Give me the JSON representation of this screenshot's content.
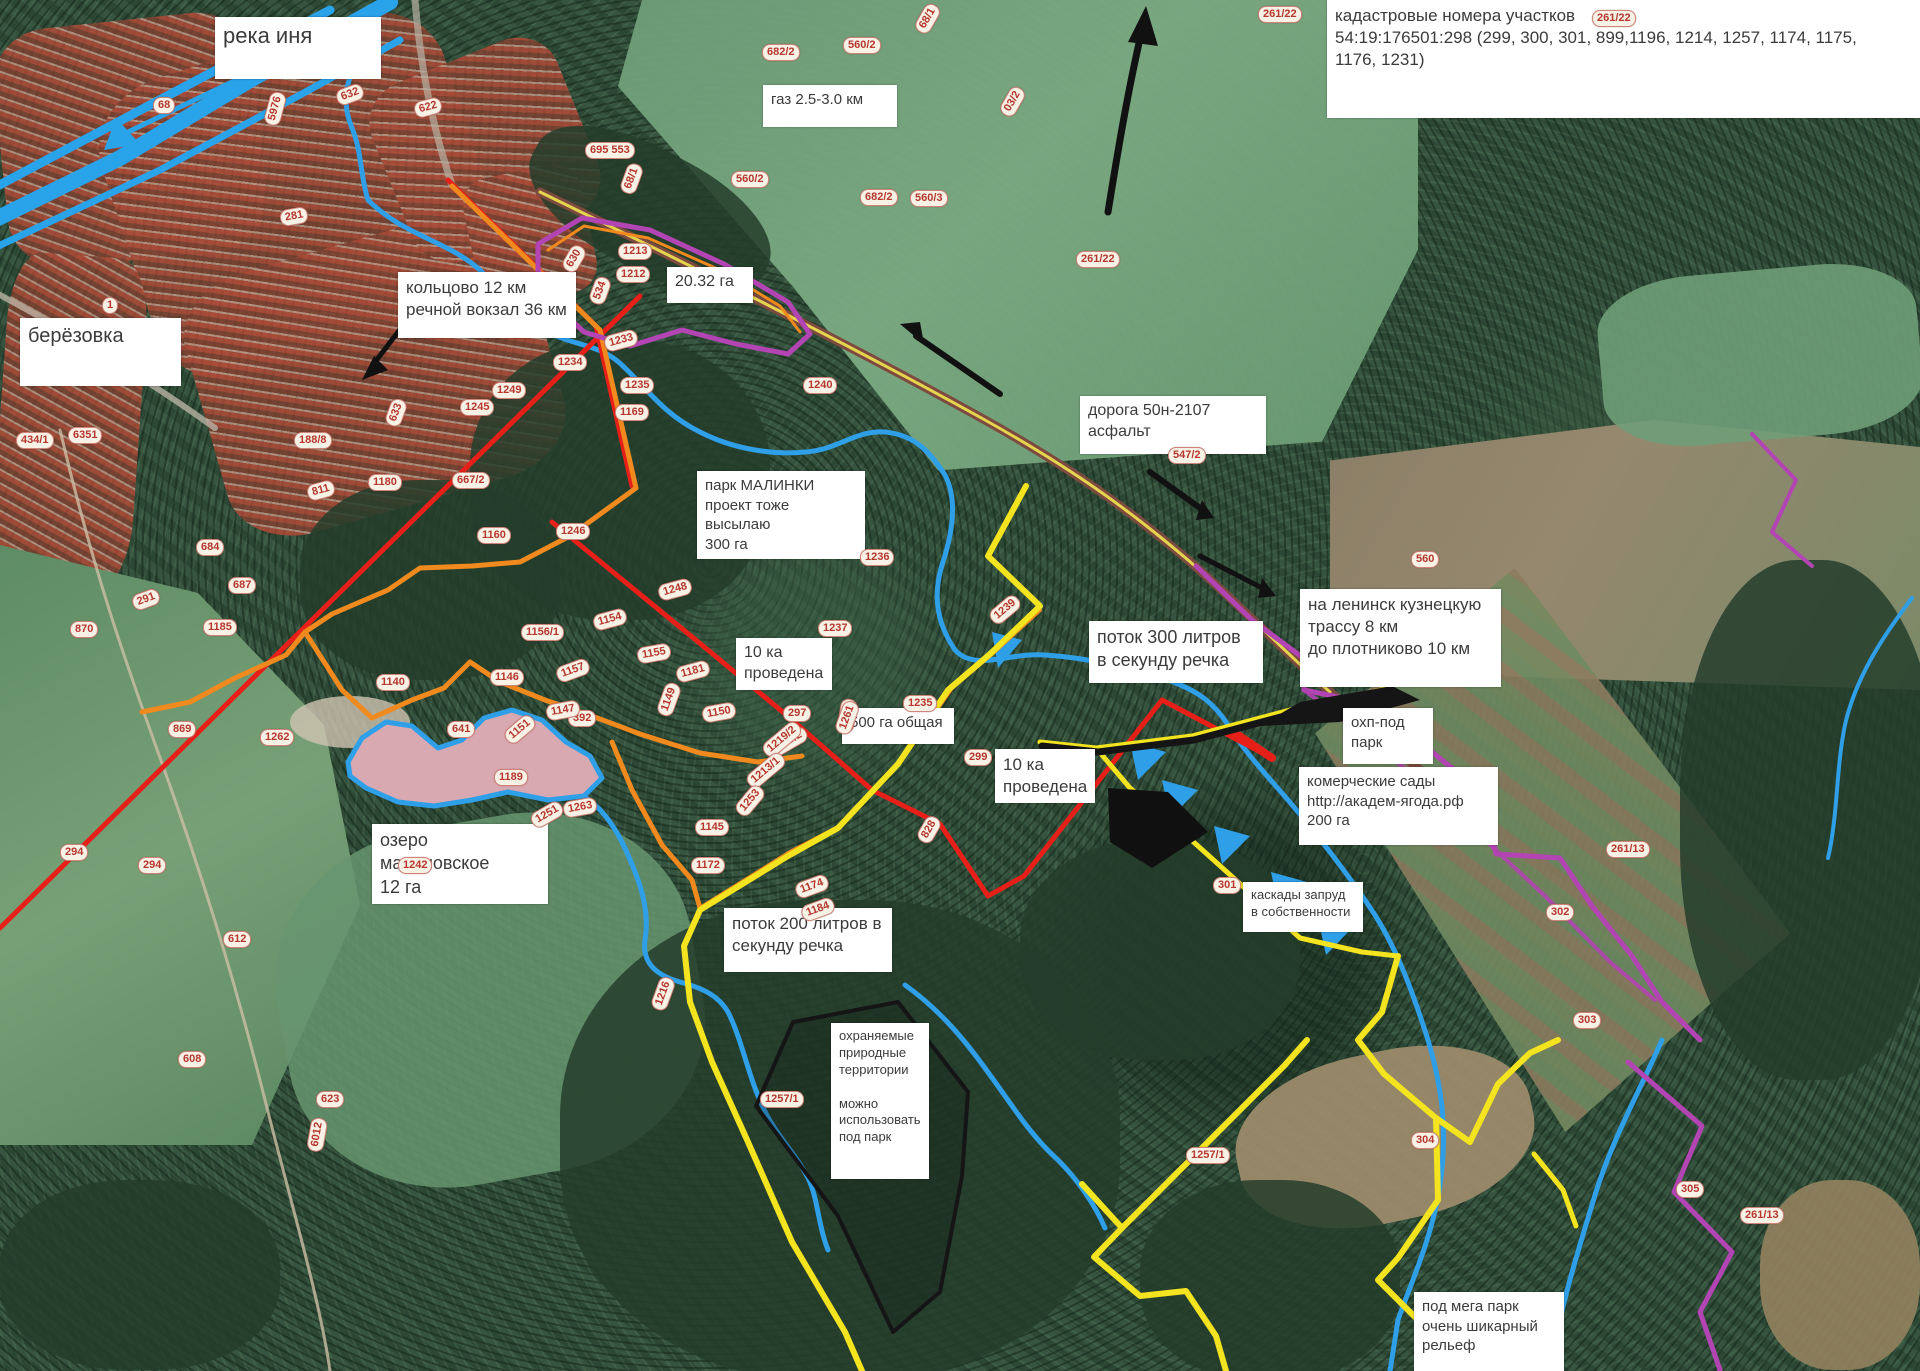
{
  "title": "карта участков (спутник) — малинки",
  "colors": {
    "river": "#2f9fe8",
    "boundary_red": "#e62019",
    "boundary_orange": "#f08a1e",
    "boundary_yellow": "#f4e420",
    "boundary_purple": "#b344b3",
    "road_brown": "#7c4a3e",
    "arrow_black": "#111111",
    "lake_fill": "#d9a9b2",
    "annotation_bg": "#ffffff",
    "annotation_text": "#3b3b3b",
    "cadastral_text": "#b5372e"
  },
  "annotations": [
    {
      "id": "reka-inya",
      "x": 215,
      "y": 17,
      "w": 150,
      "h": 52,
      "fs": 22,
      "lines": [
        "река иня"
      ]
    },
    {
      "id": "kadastr-numbers",
      "x": 1327,
      "y": 0,
      "w": 590,
      "h": 108,
      "fs": 17,
      "lines": [
        "кадастровые номера участков",
        "54:19:176501:298 (299, 300, 301, 899,1196, 1214, 1257, 1174, 1175,",
        "1176, 1231)"
      ]
    },
    {
      "id": "gaz",
      "x": 763,
      "y": 85,
      "w": 118,
      "h": 32,
      "fs": 15,
      "lines": [
        "газ 2.5-3.0 км"
      ]
    },
    {
      "id": "berezovka",
      "x": 20,
      "y": 318,
      "w": 145,
      "h": 58,
      "fs": 20,
      "lines": [
        "берёзовка"
      ]
    },
    {
      "id": "koltsovo",
      "x": 398,
      "y": 272,
      "w": 162,
      "h": 56,
      "fs": 17,
      "lines": [
        "кольцово 12 км",
        "речной вокзал 36 км"
      ]
    },
    {
      "id": "ga-20-32",
      "x": 667,
      "y": 267,
      "w": 70,
      "h": 26,
      "fs": 16,
      "lines": [
        "20.32 га"
      ]
    },
    {
      "id": "doroga-50n-2107",
      "x": 1080,
      "y": 396,
      "w": 170,
      "h": 48,
      "fs": 16,
      "lines": [
        "дорога 50н-2107",
        "асфальт"
      ]
    },
    {
      "id": "park-malinki",
      "x": 697,
      "y": 471,
      "w": 152,
      "h": 60,
      "fs": 15,
      "lines": [
        "парк  МАЛИНКИ",
        "проект тоже высылаю",
        "300 га"
      ]
    },
    {
      "id": "lep-10-1",
      "x": 736,
      "y": 638,
      "w": 80,
      "h": 38,
      "fs": 16,
      "lines": [
        "10 ка",
        "проведена"
      ]
    },
    {
      "id": "potok-300",
      "x": 1089,
      "y": 621,
      "w": 158,
      "h": 52,
      "fs": 18,
      "lines": [
        "поток 300 литров",
        "в секунду речка"
      ]
    },
    {
      "id": "leninsk-trassa",
      "x": 1300,
      "y": 589,
      "w": 185,
      "h": 88,
      "fs": 17,
      "lines": [
        "на ленинск кузнецкую",
        "трассу 8 км",
        "до плотниково 10 км"
      ]
    },
    {
      "id": "ohp-pod-park",
      "x": 1343,
      "y": 708,
      "w": 74,
      "h": 46,
      "fs": 15,
      "lines": [
        "охп-под",
        "парк"
      ]
    },
    {
      "id": "kommercheskie-sady",
      "x": 1299,
      "y": 767,
      "w": 183,
      "h": 68,
      "fs": 15,
      "lines": [
        "комерческие сады",
        "http://академ-ягода.рф",
        "200 га"
      ]
    },
    {
      "id": "ozero-malinovskoe",
      "x": 372,
      "y": 824,
      "w": 160,
      "h": 54,
      "fs": 18,
      "lines": [
        "озеро малиновское",
        "12 га"
      ]
    },
    {
      "id": "lep-10-2",
      "x": 995,
      "y": 749,
      "w": 84,
      "h": 42,
      "fs": 17,
      "lines": [
        "10 ка",
        "проведена"
      ]
    },
    {
      "id": "ga-500",
      "x": 842,
      "y": 708,
      "w": 96,
      "h": 26,
      "fs": 15,
      "lines": [
        "500 га общая"
      ]
    },
    {
      "id": "kaskady",
      "x": 1243,
      "y": 882,
      "w": 104,
      "h": 40,
      "fs": 13,
      "lines": [
        "каскады запруд",
        "в собственности"
      ]
    },
    {
      "id": "potok-200",
      "x": 724,
      "y": 908,
      "w": 152,
      "h": 54,
      "fs": 17,
      "lines": [
        "поток 200 литров в",
        "секунду речка"
      ]
    },
    {
      "id": "ohranyaemye",
      "x": 831,
      "y": 1023,
      "w": 82,
      "h": 146,
      "fs": 13,
      "lines": [
        "охраняемые",
        "природные",
        "территории",
        "",
        "можно",
        "использовать",
        "под парк"
      ]
    },
    {
      "id": "mega-park",
      "x": 1414,
      "y": 1292,
      "w": 134,
      "h": 70,
      "fs": 15,
      "lines": [
        "под мега парк",
        "очень шикарный",
        "рельеф"
      ]
    }
  ],
  "cadastral_labels": [
    {
      "t": "5976",
      "x": 258,
      "y": 100,
      "r": -75
    },
    {
      "t": "632",
      "x": 336,
      "y": 86,
      "r": -20
    },
    {
      "t": "622",
      "x": 414,
      "y": 99,
      "r": -15
    },
    {
      "t": "281",
      "x": 280,
      "y": 208,
      "r": -10
    },
    {
      "t": "68",
      "x": 153,
      "y": 97,
      "r": 0
    },
    {
      "t": "1",
      "x": 102,
      "y": 297,
      "r": 0
    },
    {
      "t": "6351",
      "x": 68,
      "y": 427,
      "r": 0
    },
    {
      "t": "434/1",
      "x": 16,
      "y": 432,
      "r": 0
    },
    {
      "t": "695 553",
      "x": 585,
      "y": 142,
      "r": 0
    },
    {
      "t": "68/1",
      "x": 616,
      "y": 170,
      "r": -70
    },
    {
      "t": "560/2",
      "x": 731,
      "y": 171,
      "r": 0
    },
    {
      "t": "682/2",
      "x": 762,
      "y": 44,
      "r": 0
    },
    {
      "t": "560/2",
      "x": 843,
      "y": 37,
      "r": 0
    },
    {
      "t": "68/1",
      "x": 912,
      "y": 10,
      "r": -60
    },
    {
      "t": "682/2",
      "x": 860,
      "y": 189,
      "r": 0
    },
    {
      "t": "560/3",
      "x": 910,
      "y": 190,
      "r": 0
    },
    {
      "t": "03/2",
      "x": 997,
      "y": 93,
      "r": -60
    },
    {
      "t": "261/22",
      "x": 1258,
      "y": 6,
      "r": 0
    },
    {
      "t": "261/22",
      "x": 1592,
      "y": 10,
      "r": 0
    },
    {
      "t": "261/22",
      "x": 1076,
      "y": 251,
      "r": 0
    },
    {
      "t": "547/2",
      "x": 1168,
      "y": 447,
      "r": 0
    },
    {
      "t": "630",
      "x": 560,
      "y": 250,
      "r": -60
    },
    {
      "t": "534",
      "x": 586,
      "y": 282,
      "r": -70
    },
    {
      "t": "1213",
      "x": 618,
      "y": 243,
      "r": 0
    },
    {
      "t": "1212",
      "x": 616,
      "y": 266,
      "r": 0
    },
    {
      "t": "1233",
      "x": 604,
      "y": 332,
      "r": -15
    },
    {
      "t": "1234",
      "x": 553,
      "y": 354,
      "r": 0
    },
    {
      "t": "1235",
      "x": 620,
      "y": 377,
      "r": 0
    },
    {
      "t": "1240",
      "x": 803,
      "y": 377,
      "r": 0
    },
    {
      "t": "1249",
      "x": 492,
      "y": 382,
      "r": 0
    },
    {
      "t": "1245",
      "x": 460,
      "y": 399,
      "r": 0
    },
    {
      "t": "633",
      "x": 382,
      "y": 404,
      "r": -70
    },
    {
      "t": "188/8",
      "x": 294,
      "y": 432,
      "r": 0
    },
    {
      "t": "811",
      "x": 307,
      "y": 482,
      "r": -15
    },
    {
      "t": "1180",
      "x": 368,
      "y": 474,
      "r": 0
    },
    {
      "t": "667/2",
      "x": 452,
      "y": 472,
      "r": 0
    },
    {
      "t": "1160",
      "x": 477,
      "y": 527,
      "r": 0
    },
    {
      "t": "1246",
      "x": 556,
      "y": 523,
      "r": 0
    },
    {
      "t": "1169",
      "x": 615,
      "y": 404,
      "r": 0
    },
    {
      "t": "1236",
      "x": 860,
      "y": 549,
      "r": 0
    },
    {
      "t": "1237",
      "x": 818,
      "y": 620,
      "r": 0
    },
    {
      "t": "1238",
      "x": 830,
      "y": 707,
      "r": -80
    },
    {
      "t": "1239",
      "x": 988,
      "y": 601,
      "r": -40
    },
    {
      "t": "1235",
      "x": 903,
      "y": 695,
      "r": 0
    },
    {
      "t": "299",
      "x": 964,
      "y": 749,
      "r": 0
    },
    {
      "t": "297",
      "x": 783,
      "y": 705,
      "r": 0
    },
    {
      "t": "1261",
      "x": 830,
      "y": 709,
      "r": -70
    },
    {
      "t": "1215/2",
      "x": 765,
      "y": 734,
      "r": -30
    },
    {
      "t": "1156/1",
      "x": 521,
      "y": 624,
      "r": 0
    },
    {
      "t": "1154",
      "x": 593,
      "y": 611,
      "r": -15
    },
    {
      "t": "1155",
      "x": 637,
      "y": 645,
      "r": -10
    },
    {
      "t": "1248",
      "x": 658,
      "y": 581,
      "r": -15
    },
    {
      "t": "1181",
      "x": 676,
      "y": 663,
      "r": -15
    },
    {
      "t": "1149",
      "x": 652,
      "y": 691,
      "r": -70
    },
    {
      "t": "392",
      "x": 568,
      "y": 710,
      "r": 0
    },
    {
      "t": "1150",
      "x": 702,
      "y": 704,
      "r": -10
    },
    {
      "t": "1140",
      "x": 376,
      "y": 674,
      "r": 0
    },
    {
      "t": "1146",
      "x": 490,
      "y": 669,
      "r": 0
    },
    {
      "t": "1147",
      "x": 546,
      "y": 702,
      "r": -10
    },
    {
      "t": "1157",
      "x": 556,
      "y": 662,
      "r": -20
    },
    {
      "t": "641",
      "x": 447,
      "y": 721,
      "r": 0
    },
    {
      "t": "1151",
      "x": 503,
      "y": 721,
      "r": -40
    },
    {
      "t": "1189",
      "x": 494,
      "y": 769,
      "r": 0
    },
    {
      "t": "1263",
      "x": 563,
      "y": 799,
      "r": -10
    },
    {
      "t": "1262",
      "x": 260,
      "y": 729,
      "r": 0
    },
    {
      "t": "869",
      "x": 168,
      "y": 721,
      "r": 0
    },
    {
      "t": "291",
      "x": 132,
      "y": 591,
      "r": -20
    },
    {
      "t": "870",
      "x": 70,
      "y": 621,
      "r": 0
    },
    {
      "t": "1185",
      "x": 203,
      "y": 619,
      "r": 0
    },
    {
      "t": "687",
      "x": 228,
      "y": 577,
      "r": 0
    },
    {
      "t": "684",
      "x": 196,
      "y": 539,
      "r": 0
    },
    {
      "t": "294",
      "x": 60,
      "y": 844,
      "r": 0
    },
    {
      "t": "294",
      "x": 138,
      "y": 857,
      "r": 0
    },
    {
      "t": "1242",
      "x": 398,
      "y": 857,
      "r": 0
    },
    {
      "t": "612",
      "x": 223,
      "y": 931,
      "r": 0
    },
    {
      "t": "608",
      "x": 178,
      "y": 1051,
      "r": 0
    },
    {
      "t": "623",
      "x": 316,
      "y": 1091,
      "r": 0
    },
    {
      "t": "6012",
      "x": 300,
      "y": 1126,
      "r": -80
    },
    {
      "t": "1251",
      "x": 530,
      "y": 806,
      "r": -30
    },
    {
      "t": "1145",
      "x": 695,
      "y": 819,
      "r": 0
    },
    {
      "t": "1172",
      "x": 691,
      "y": 857,
      "r": 0
    },
    {
      "t": "1216",
      "x": 646,
      "y": 985,
      "r": -70
    },
    {
      "t": "1257/1",
      "x": 760,
      "y": 1091,
      "r": 0
    },
    {
      "t": "1257/1",
      "x": 1186,
      "y": 1147,
      "r": 0
    },
    {
      "t": "304",
      "x": 1411,
      "y": 1132,
      "r": 0
    },
    {
      "t": "828",
      "x": 915,
      "y": 821,
      "r": -60
    },
    {
      "t": "1219/2",
      "x": 760,
      "y": 731,
      "r": -40
    },
    {
      "t": "1213/1",
      "x": 744,
      "y": 762,
      "r": -40
    },
    {
      "t": "1253",
      "x": 733,
      "y": 792,
      "r": -50
    },
    {
      "t": "1174",
      "x": 795,
      "y": 878,
      "r": -20
    },
    {
      "t": "1184",
      "x": 801,
      "y": 901,
      "r": -20
    },
    {
      "t": "301",
      "x": 1213,
      "y": 877,
      "r": 0
    },
    {
      "t": "302",
      "x": 1546,
      "y": 904,
      "r": 0
    },
    {
      "t": "303",
      "x": 1573,
      "y": 1012,
      "r": 0
    },
    {
      "t": "261/13",
      "x": 1606,
      "y": 841,
      "r": 0
    },
    {
      "t": "305",
      "x": 1676,
      "y": 1181,
      "r": 0
    },
    {
      "t": "261/13",
      "x": 1740,
      "y": 1207,
      "r": 0
    },
    {
      "t": "560",
      "x": 1411,
      "y": 551,
      "r": 0
    }
  ]
}
